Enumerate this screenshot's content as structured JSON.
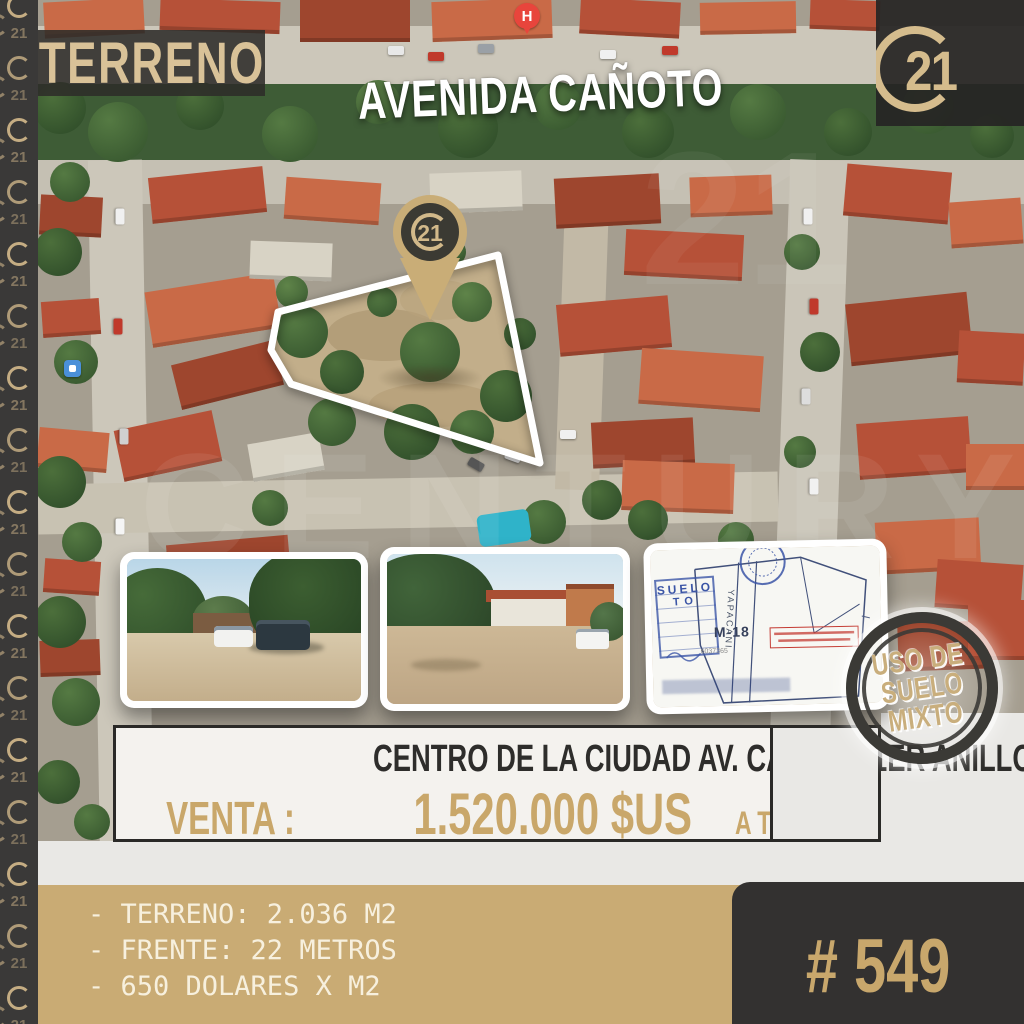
{
  "colors": {
    "gold": "#c9ab74",
    "gold_text": "#d9c298",
    "dark": "#343331",
    "price": "#c9a76a",
    "cream": "#f7f0de",
    "stamp_text": "#c9ae7c"
  },
  "left_strip": {
    "ring_label": "21"
  },
  "title_badge": "TERRENO",
  "street_banner": "AVENIDA CAÑOTO",
  "brand": {
    "number": "21"
  },
  "pin": {
    "number": "21"
  },
  "map": {
    "hospital_marker": "H",
    "watermark_word": "CENTURY",
    "watermark_number": "21"
  },
  "stamp": {
    "line1": "USO DE",
    "line2": "SUELO",
    "line3": "MIXTO"
  },
  "plan": {
    "block": "M-18",
    "street": "YAPACANI",
    "number": "6037365",
    "stamp_top": "SUELO",
    "stamp_bottom": "TO"
  },
  "info": {
    "location": "CENTRO DE LA CIUDAD AV. CAÑOTO 1ER ANILLO",
    "sale": "VENTA :",
    "price": "1.520.000 $US",
    "rate": "A TC 7"
  },
  "details": {
    "line1": "- TERRENO: 2.036 M2",
    "line2": "- FRENTE: 22 METROS",
    "line3": "- 650 DOLARES X M2"
  },
  "listing_number": "# 549"
}
